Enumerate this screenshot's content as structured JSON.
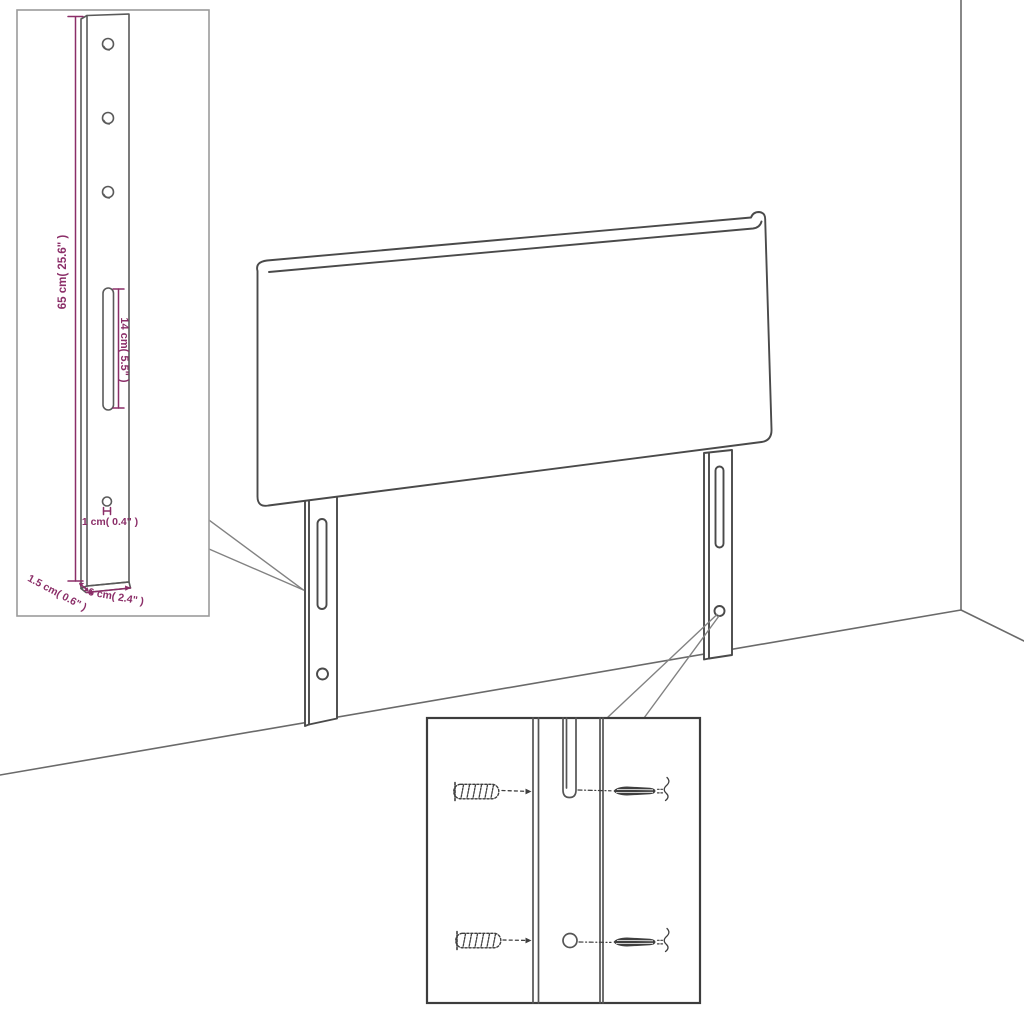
{
  "canvas": {
    "width": 1024,
    "height": 1024,
    "background": "#ffffff"
  },
  "colors": {
    "drawing_outline": "#4a4a4a",
    "room_line": "#6a6a6a",
    "leader_line": "#828282",
    "bracket_line": "#5a5a5a",
    "detail_box_light_border": "#9b9b9b",
    "detail_box_dark_border": "#3d3d3d",
    "dimension_accent": "#8b2e68",
    "hardware": "#3f3f3f"
  },
  "bracket_inset": {
    "labels": {
      "height": "65 cm( 25.6\" )",
      "slot": "14 cm( 5.5\" )",
      "hole": "1 cm( 0.4\" )",
      "depth": "1.5 cm( 0.6\" )",
      "width": "6 cm( 2.4\" )"
    },
    "icons": [
      "mounting-hole-icon",
      "adjustment-slot-icon"
    ]
  },
  "mounting_inset": {
    "icons": [
      "wall-plug-icon",
      "screw-icon",
      "wall-break-squiggle-icon"
    ]
  }
}
